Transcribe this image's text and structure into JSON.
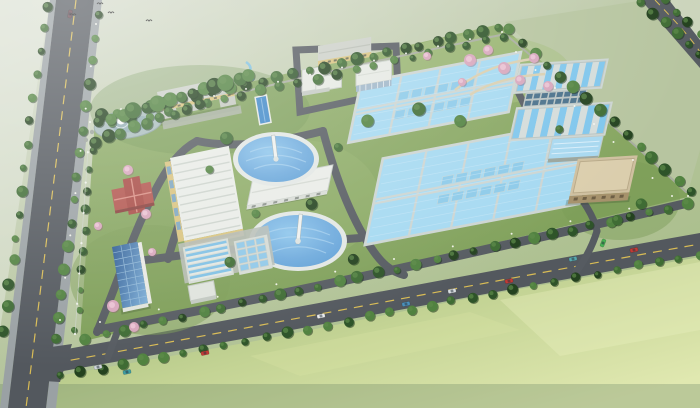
{
  "scene": {
    "kind": "aerial-3d-architectural-rendering",
    "subject": "water treatment plant campus viewed from above at an oblique angle",
    "surroundings": "open green fields, tree-lined public roads on the left, bottom and upper-right, birds flying top-left"
  },
  "palette": {
    "field_far": "#ccd5c1",
    "field_mid": "#b2c398",
    "field_near": "#9ab873",
    "field_bright": "#d8e2a6",
    "site_grass": "#89a862",
    "road": "#54595f",
    "road_edge": "#979ea3",
    "road_line_yellow": "#d9bc55",
    "internal_road": "#565b61",
    "basin_water": "#a5d9f1",
    "basin_wall": "#ccd5d2",
    "filter_water": "#7fc6ec",
    "clarifier_water_dark": "#5f9fd6",
    "clarifier_water_light": "#8ec6ec",
    "clarifier_rim": "#e2e7e4",
    "roof_white": "#e9ece7",
    "roof_gray": "#c9cec7",
    "roof_blue": "#a8d8f0",
    "roof_solar": "#3f6fa9",
    "roof_red": "#b2554e",
    "wall_yellow": "#d9c37e",
    "building_tan": "#cfc0a0",
    "tan_wall": "#a6926c",
    "tree_dark": "#24421f",
    "tree_mid": "#2e5429",
    "tree_light": "#3f6c34",
    "tree_bright": "#518240",
    "tree_pink": "#d7a6bc",
    "pond_water": "#a9bdbd",
    "fountain_white": "#ffffff",
    "pool_blue": "#3f88c8"
  },
  "facility": {
    "components": [
      {
        "id": "admin-building",
        "label": "administration building",
        "count": 1
      },
      {
        "id": "workshop-building",
        "label": "long workshop building",
        "count": 1
      },
      {
        "id": "white-roof-buildings",
        "label": "auxiliary white-roof buildings",
        "count": 2
      },
      {
        "id": "production-building",
        "label": "large production hall",
        "count": 1
      },
      {
        "id": "circular-clarifiers",
        "label": "circular clarifier tanks with scraper bridges",
        "count": 2
      },
      {
        "id": "sludge-building",
        "label": "long white building between clarifiers",
        "count": 1
      },
      {
        "id": "aeration-basins",
        "label": "rectangular aeration basin blocks",
        "count": 2
      },
      {
        "id": "filter-basins",
        "label": "striped filter basin blocks",
        "count": 2
      },
      {
        "id": "blue-roof-building",
        "label": "blue-roof pump building",
        "count": 1
      },
      {
        "id": "blower-building",
        "label": "tan blower building",
        "count": 1
      },
      {
        "id": "grit-tank-groups",
        "label": "small channel tank groups",
        "count": 2
      },
      {
        "id": "solar-roof-building",
        "label": "building with dark glazed roof",
        "count": 1
      },
      {
        "id": "red-roof-building",
        "label": "red hip-roof building in garden",
        "count": 1
      },
      {
        "id": "pond-fountain",
        "label": "landscape pond with fountain",
        "count": 1
      },
      {
        "id": "lap-pool",
        "label": "narrow blue pool",
        "count": 1
      }
    ]
  },
  "vehicles": {
    "cars": [
      {
        "x": 70,
        "y": 14,
        "angle": -80,
        "color": "#6a4a52"
      },
      {
        "x": 98,
        "y": 367,
        "angle": -12,
        "color": "#cdd3d8"
      },
      {
        "x": 127,
        "y": 372,
        "angle": -12,
        "color": "#3e9da2"
      },
      {
        "x": 205,
        "y": 353,
        "angle": -12,
        "color": "#c23a35"
      },
      {
        "x": 321,
        "y": 316,
        "angle": -12,
        "color": "#e9ebed"
      },
      {
        "x": 406,
        "y": 304,
        "angle": -12,
        "color": "#4a90bb"
      },
      {
        "x": 452,
        "y": 291,
        "angle": -12,
        "color": "#d9dee1"
      },
      {
        "x": 509,
        "y": 281,
        "angle": -12,
        "color": "#c23a35"
      },
      {
        "x": 573,
        "y": 259,
        "angle": -12,
        "color": "#57a7ad"
      },
      {
        "x": 634,
        "y": 250,
        "angle": -12,
        "color": "#c23a35"
      },
      {
        "x": 603,
        "y": 243,
        "angle": -68,
        "color": "#47b153"
      }
    ]
  },
  "birds": {
    "count": 4,
    "positions": [
      [
        100,
        4
      ],
      [
        111,
        13
      ],
      [
        73,
        15
      ],
      [
        149,
        21
      ]
    ]
  }
}
